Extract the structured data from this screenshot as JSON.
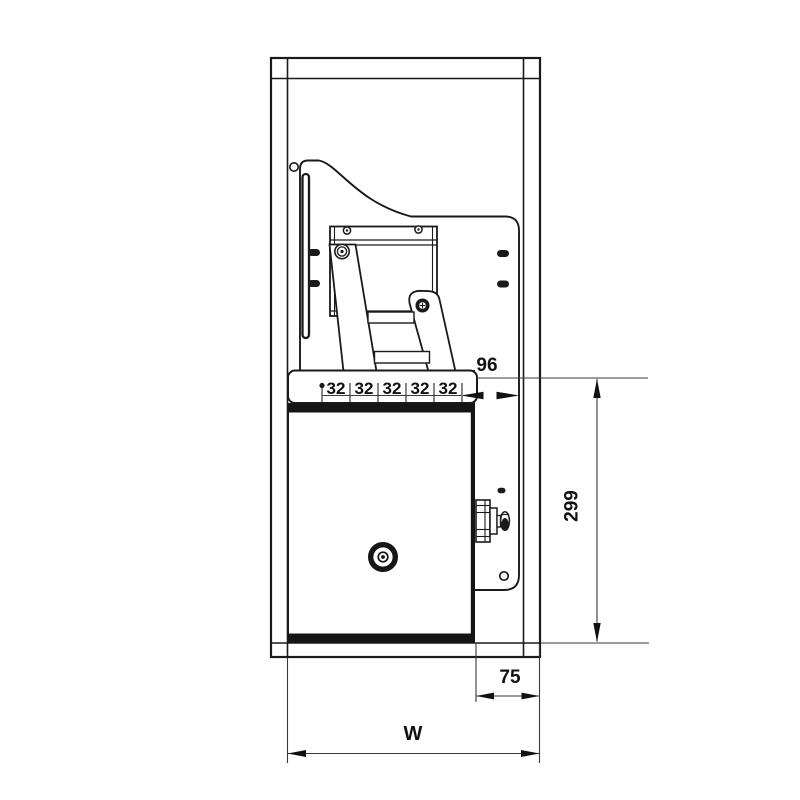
{
  "drawing": {
    "dim_96": "96",
    "hole_pitch": [
      "32",
      "32",
      "32",
      "32",
      "32"
    ],
    "dim_299": "299",
    "dim_75": "75",
    "dim_width": "W",
    "line_color": "#1a1a1a",
    "dim_line_color": "#3a3a3a"
  }
}
